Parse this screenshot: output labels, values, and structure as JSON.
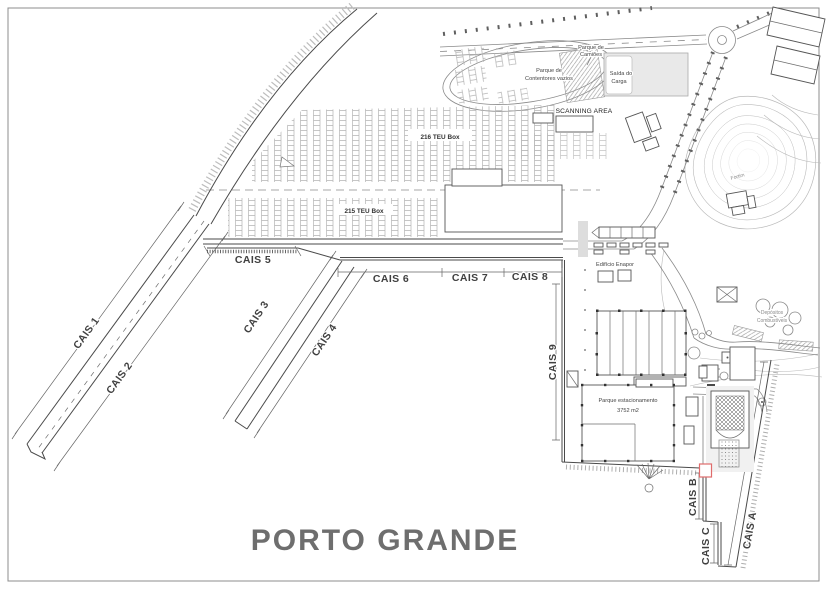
{
  "title": "PORTO GRANDE",
  "colors": {
    "highlight": "#e06c6c",
    "title": "#6e6e6e"
  },
  "quays": {
    "c1": "CAIS 1",
    "c2": "CAIS 2",
    "c3": "CAIS 3",
    "c4": "CAIS 4",
    "c5": "CAIS 5",
    "c6": "CAIS 6",
    "c7": "CAIS 7",
    "c8": "CAIS 8",
    "c9": "CAIS 9",
    "ca": "CAIS A",
    "cb": "CAIS B",
    "cc": "CAIS C"
  },
  "areas": {
    "truck_park_l1": "Parque de",
    "truck_park_l2": "Camiões",
    "empty_containers_l1": "Parque de",
    "empty_containers_l2": "Contentores vazios",
    "cargo_exit_l1": "Saída do",
    "cargo_exit_l2": "Carga",
    "scanning": "SCANNING AREA",
    "teu216": "216 TEU Box",
    "teu215": "215 TEU Box",
    "enapor": "Edifício Enapor",
    "parking_l1": "Parque estacionamento",
    "parking_l2": "3752 m2",
    "fort": "Fortim",
    "fuel_l1": "Depósitos",
    "fuel_l2": "Combustíveis"
  }
}
